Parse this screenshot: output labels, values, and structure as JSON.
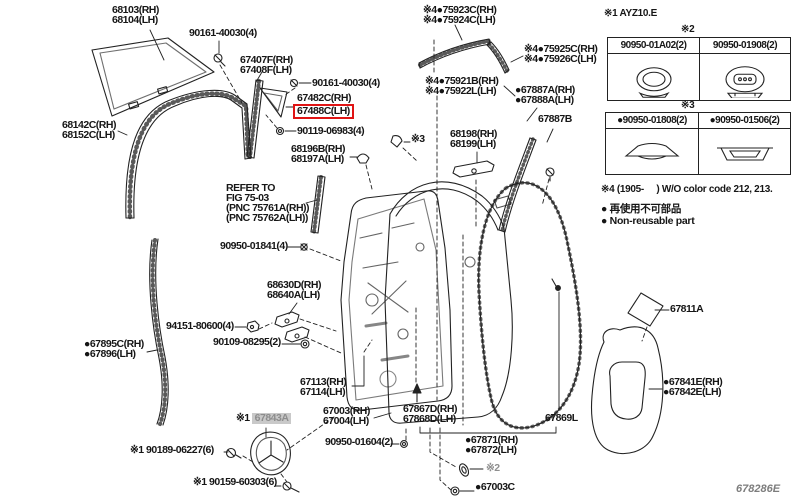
{
  "page": {
    "background": "#ffffff",
    "ink_color": "#222222",
    "highlight_color": "#e01414",
    "gray_badge_bg": "#c9c9c9",
    "gray_badge_text": "#8d8d8d"
  },
  "footer_code": "678286E",
  "labels": [
    {
      "name": "label-68103",
      "x": 112,
      "y": 5,
      "lines": [
        "68103(RH)",
        "68104(LH)"
      ]
    },
    {
      "name": "label-90161-40030-a",
      "x": 189,
      "y": 28,
      "lines": [
        "90161-40030(4)"
      ]
    },
    {
      "name": "label-67407F",
      "x": 240,
      "y": 55,
      "lines": [
        "67407F(RH)",
        "67408F(LH)"
      ]
    },
    {
      "name": "label-90161-40030-b",
      "x": 312,
      "y": 78,
      "lines": [
        "90161-40030(4)"
      ]
    },
    {
      "name": "label-67482C",
      "x": 297,
      "y": 93,
      "lines": [
        "67482C(RH)"
      ]
    },
    {
      "name": "label-67488C-selected",
      "x": 297,
      "y": 106,
      "lines": [
        "67488C(LH)"
      ],
      "boxed": true
    },
    {
      "name": "label-90119-06983",
      "x": 297,
      "y": 126,
      "lines": [
        "90119-06983(4)"
      ]
    },
    {
      "name": "label-68196B",
      "x": 291,
      "y": 144,
      "lines": [
        "68196B(RH)",
        "68197A(LH)"
      ]
    },
    {
      "name": "label-68142C",
      "x": 62,
      "y": 120,
      "lines": [
        "68142C(RH)",
        "68152C(LH)"
      ]
    },
    {
      "name": "label-refer-fig-75-03",
      "x": 226,
      "y": 183,
      "lines": [
        "REFER TO",
        "FIG 75-03",
        "(PNC 75761A(RH))",
        "(PNC 75762A(LH))"
      ]
    },
    {
      "name": "label-90950-01841",
      "x": 220,
      "y": 241,
      "lines": [
        "90950-01841(4)"
      ]
    },
    {
      "name": "label-94151-80600",
      "x": 166,
      "y": 321,
      "lines": [
        "94151-80600(4)"
      ]
    },
    {
      "name": "label-90109-08295",
      "x": 213,
      "y": 337,
      "lines": [
        "90109-08295(2)"
      ]
    },
    {
      "name": "label-67895C",
      "x": 84,
      "y": 339,
      "lines": [
        "●67895C(RH)",
        "●67896(LH)"
      ]
    },
    {
      "name": "label-68630D",
      "x": 267,
      "y": 280,
      "lines": [
        "68630D(RH)",
        "68640A(LH)"
      ]
    },
    {
      "name": "label-75923C",
      "x": 423,
      "y": 5,
      "lines": [
        "※4●75923C(RH)",
        "※4●75924C(LH)"
      ]
    },
    {
      "name": "label-75925C",
      "x": 524,
      "y": 44,
      "lines": [
        "※4●75925C(RH)",
        "※4●75926C(LH)"
      ]
    },
    {
      "name": "label-75921B",
      "x": 425,
      "y": 76,
      "lines": [
        "※4●75921B(RH)",
        "※4●75922L(LH)"
      ]
    },
    {
      "name": "label-67887A",
      "x": 515,
      "y": 85,
      "lines": [
        "●67887A(RH)",
        "●67888A(LH)"
      ]
    },
    {
      "name": "label-67887B",
      "x": 538,
      "y": 114,
      "lines": [
        "67887B"
      ]
    },
    {
      "name": "label-68198",
      "x": 450,
      "y": 129,
      "lines": [
        "68198(RH)",
        "68199(LH)"
      ]
    },
    {
      "name": "note-ref3-inline",
      "x": 411,
      "y": 134,
      "lines": [
        "※3"
      ],
      "interactable": false
    },
    {
      "name": "label-67811A",
      "x": 670,
      "y": 304,
      "lines": [
        "67811A"
      ]
    },
    {
      "name": "label-67841E",
      "x": 663,
      "y": 377,
      "lines": [
        "●67841E(RH)",
        "●67842E(LH)"
      ]
    },
    {
      "name": "label-67869L",
      "x": 545,
      "y": 413,
      "lines": [
        "67869L"
      ]
    },
    {
      "name": "label-67871",
      "x": 465,
      "y": 435,
      "lines": [
        "●67871(RH)",
        "●67872(LH)"
      ]
    },
    {
      "name": "note-ref2-inline",
      "x": 486,
      "y": 463,
      "lines": [
        "※2"
      ],
      "cls": "graynote",
      "interactable": false
    },
    {
      "name": "label-67003C",
      "x": 475,
      "y": 482,
      "lines": [
        "●67003C"
      ]
    },
    {
      "name": "label-67867D",
      "x": 403,
      "y": 404,
      "lines": [
        "67867D(RH)",
        "67868D(LH)"
      ]
    },
    {
      "name": "label-67113",
      "x": 300,
      "y": 377,
      "lines": [
        "67113(RH)",
        "67114(LH)"
      ]
    },
    {
      "name": "label-67003",
      "x": 323,
      "y": 406,
      "lines": [
        "67003(RH)",
        "67004(LH)"
      ]
    },
    {
      "name": "label-90950-01604",
      "x": 325,
      "y": 437,
      "lines": [
        "90950-01604(2)"
      ]
    },
    {
      "name": "label-67843A",
      "x": 236,
      "y": 413,
      "lines": [
        "※1"
      ],
      "badge": "67843A"
    },
    {
      "name": "label-90189-06227",
      "x": 130,
      "y": 445,
      "lines": [
        "※1 90189-06227(6)"
      ]
    },
    {
      "name": "label-90159-60303",
      "x": 193,
      "y": 477,
      "lines": [
        "※1 90159-60303(6)"
      ]
    }
  ],
  "side_panel": {
    "note1": "※1 AYZ10.E",
    "table2_caption": "※2",
    "table2": {
      "col1": "90950-01A02(2)",
      "col2": "90950-01908(2)"
    },
    "table3_caption": "※3",
    "table3": {
      "col1": "●90950-01808(2)",
      "col2": "●90950-01506(2)"
    },
    "note4": "※4 (1905-     ) W/O color code 212, 213.",
    "legend_jp": "● 再使用不可部品",
    "legend_en": "● Non-reusable part"
  }
}
